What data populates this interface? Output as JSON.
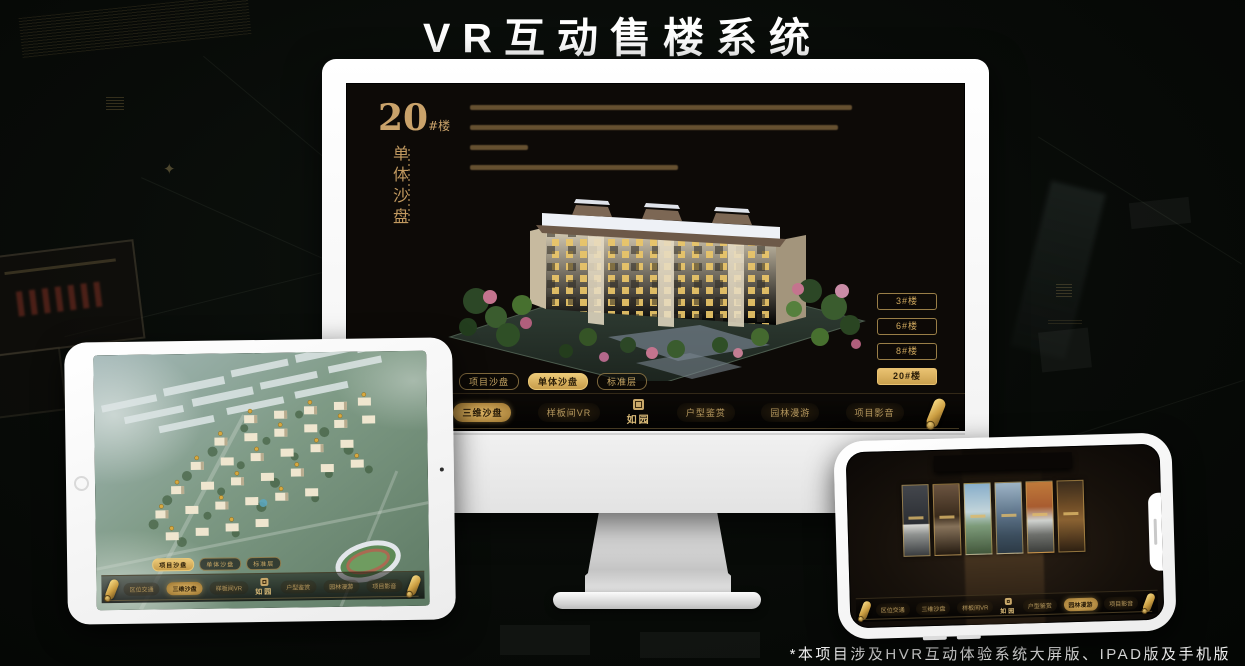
{
  "title": "VR互动售楼系统",
  "footnote": "*本项目涉及HVR互动体验系统大屏版、IPAD版及手机版",
  "colors": {
    "gold": "#C9A368",
    "gold_bright": "#E9C271",
    "screen_bg": "#0D0A07",
    "device_body": "#FFFFFF"
  },
  "shared": {
    "logo": "如园",
    "tabs": [
      "项目沙盘",
      "单体沙盘",
      "标准层"
    ],
    "nav_items": [
      "区位交通",
      "三维沙盘",
      "样板间VR",
      "户型鉴赏",
      "园林漫游",
      "项目影音"
    ],
    "icons": {
      "scroll": "scroll-icon",
      "seal": "seal-icon"
    }
  },
  "monitor": {
    "heading": {
      "number": "20",
      "suffix": "#楼",
      "vertical": "单体沙盘"
    },
    "floor_buttons": [
      {
        "label": "3#楼",
        "active": false
      },
      {
        "label": "6#楼",
        "active": false
      },
      {
        "label": "8#楼",
        "active": false
      },
      {
        "label": "20#楼",
        "active": true
      }
    ],
    "active_tab": "单体沙盘",
    "active_nav": "三维沙盘"
  },
  "ipad": {
    "active_tab": "项目沙盘",
    "active_nav": "三维沙盘"
  },
  "phone": {
    "active_nav": "园林漫游",
    "gallery_panel_count": 6
  }
}
